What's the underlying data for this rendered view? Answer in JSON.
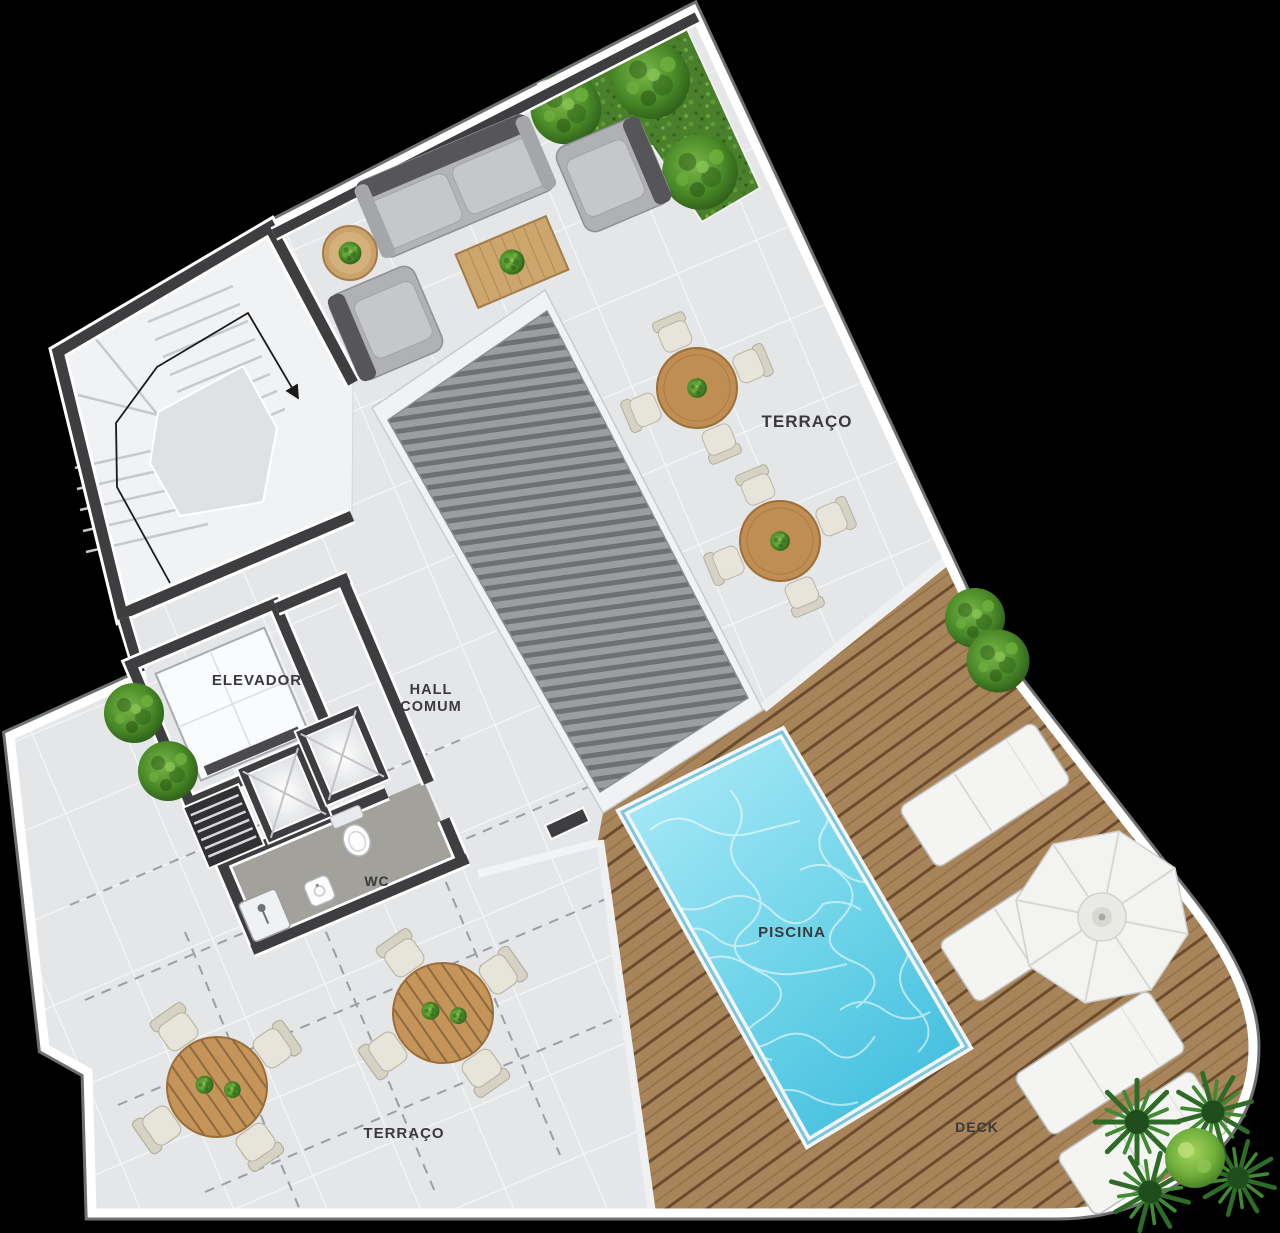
{
  "labels": {
    "terraco_top": "TERRAÇO",
    "elevador": "ELEVADOR",
    "hall_line1": "HALL",
    "hall_line2": "COMUM",
    "wc": "WC",
    "piscina": "PISCINA",
    "deck": "DECK",
    "terraco_bottom": "TERRAÇO"
  },
  "colors": {
    "background": "#000000",
    "floor": "#e4e6e8",
    "grout": "#f7f8f9",
    "wall": "#3e3e41",
    "trim": "#ffffff",
    "label": "#3a3a3c",
    "deckwood": "#a8845a",
    "deckline": "#6b4d2e",
    "poolshallow": "#9ae6f5",
    "pooldeep": "#2fb7da",
    "grass": "#4a7f2c",
    "tablewood": "#c08e52",
    "chaircream": "#e7e4da",
    "sofagray": "#b3b4b7",
    "sofaback": "#56565a",
    "whitefurn": "#f4f4f2",
    "dash": "#8f9296",
    "riblight": "#9c9da1",
    "ribdark": "#6f7074",
    "frame": "#f1f2f3"
  }
}
